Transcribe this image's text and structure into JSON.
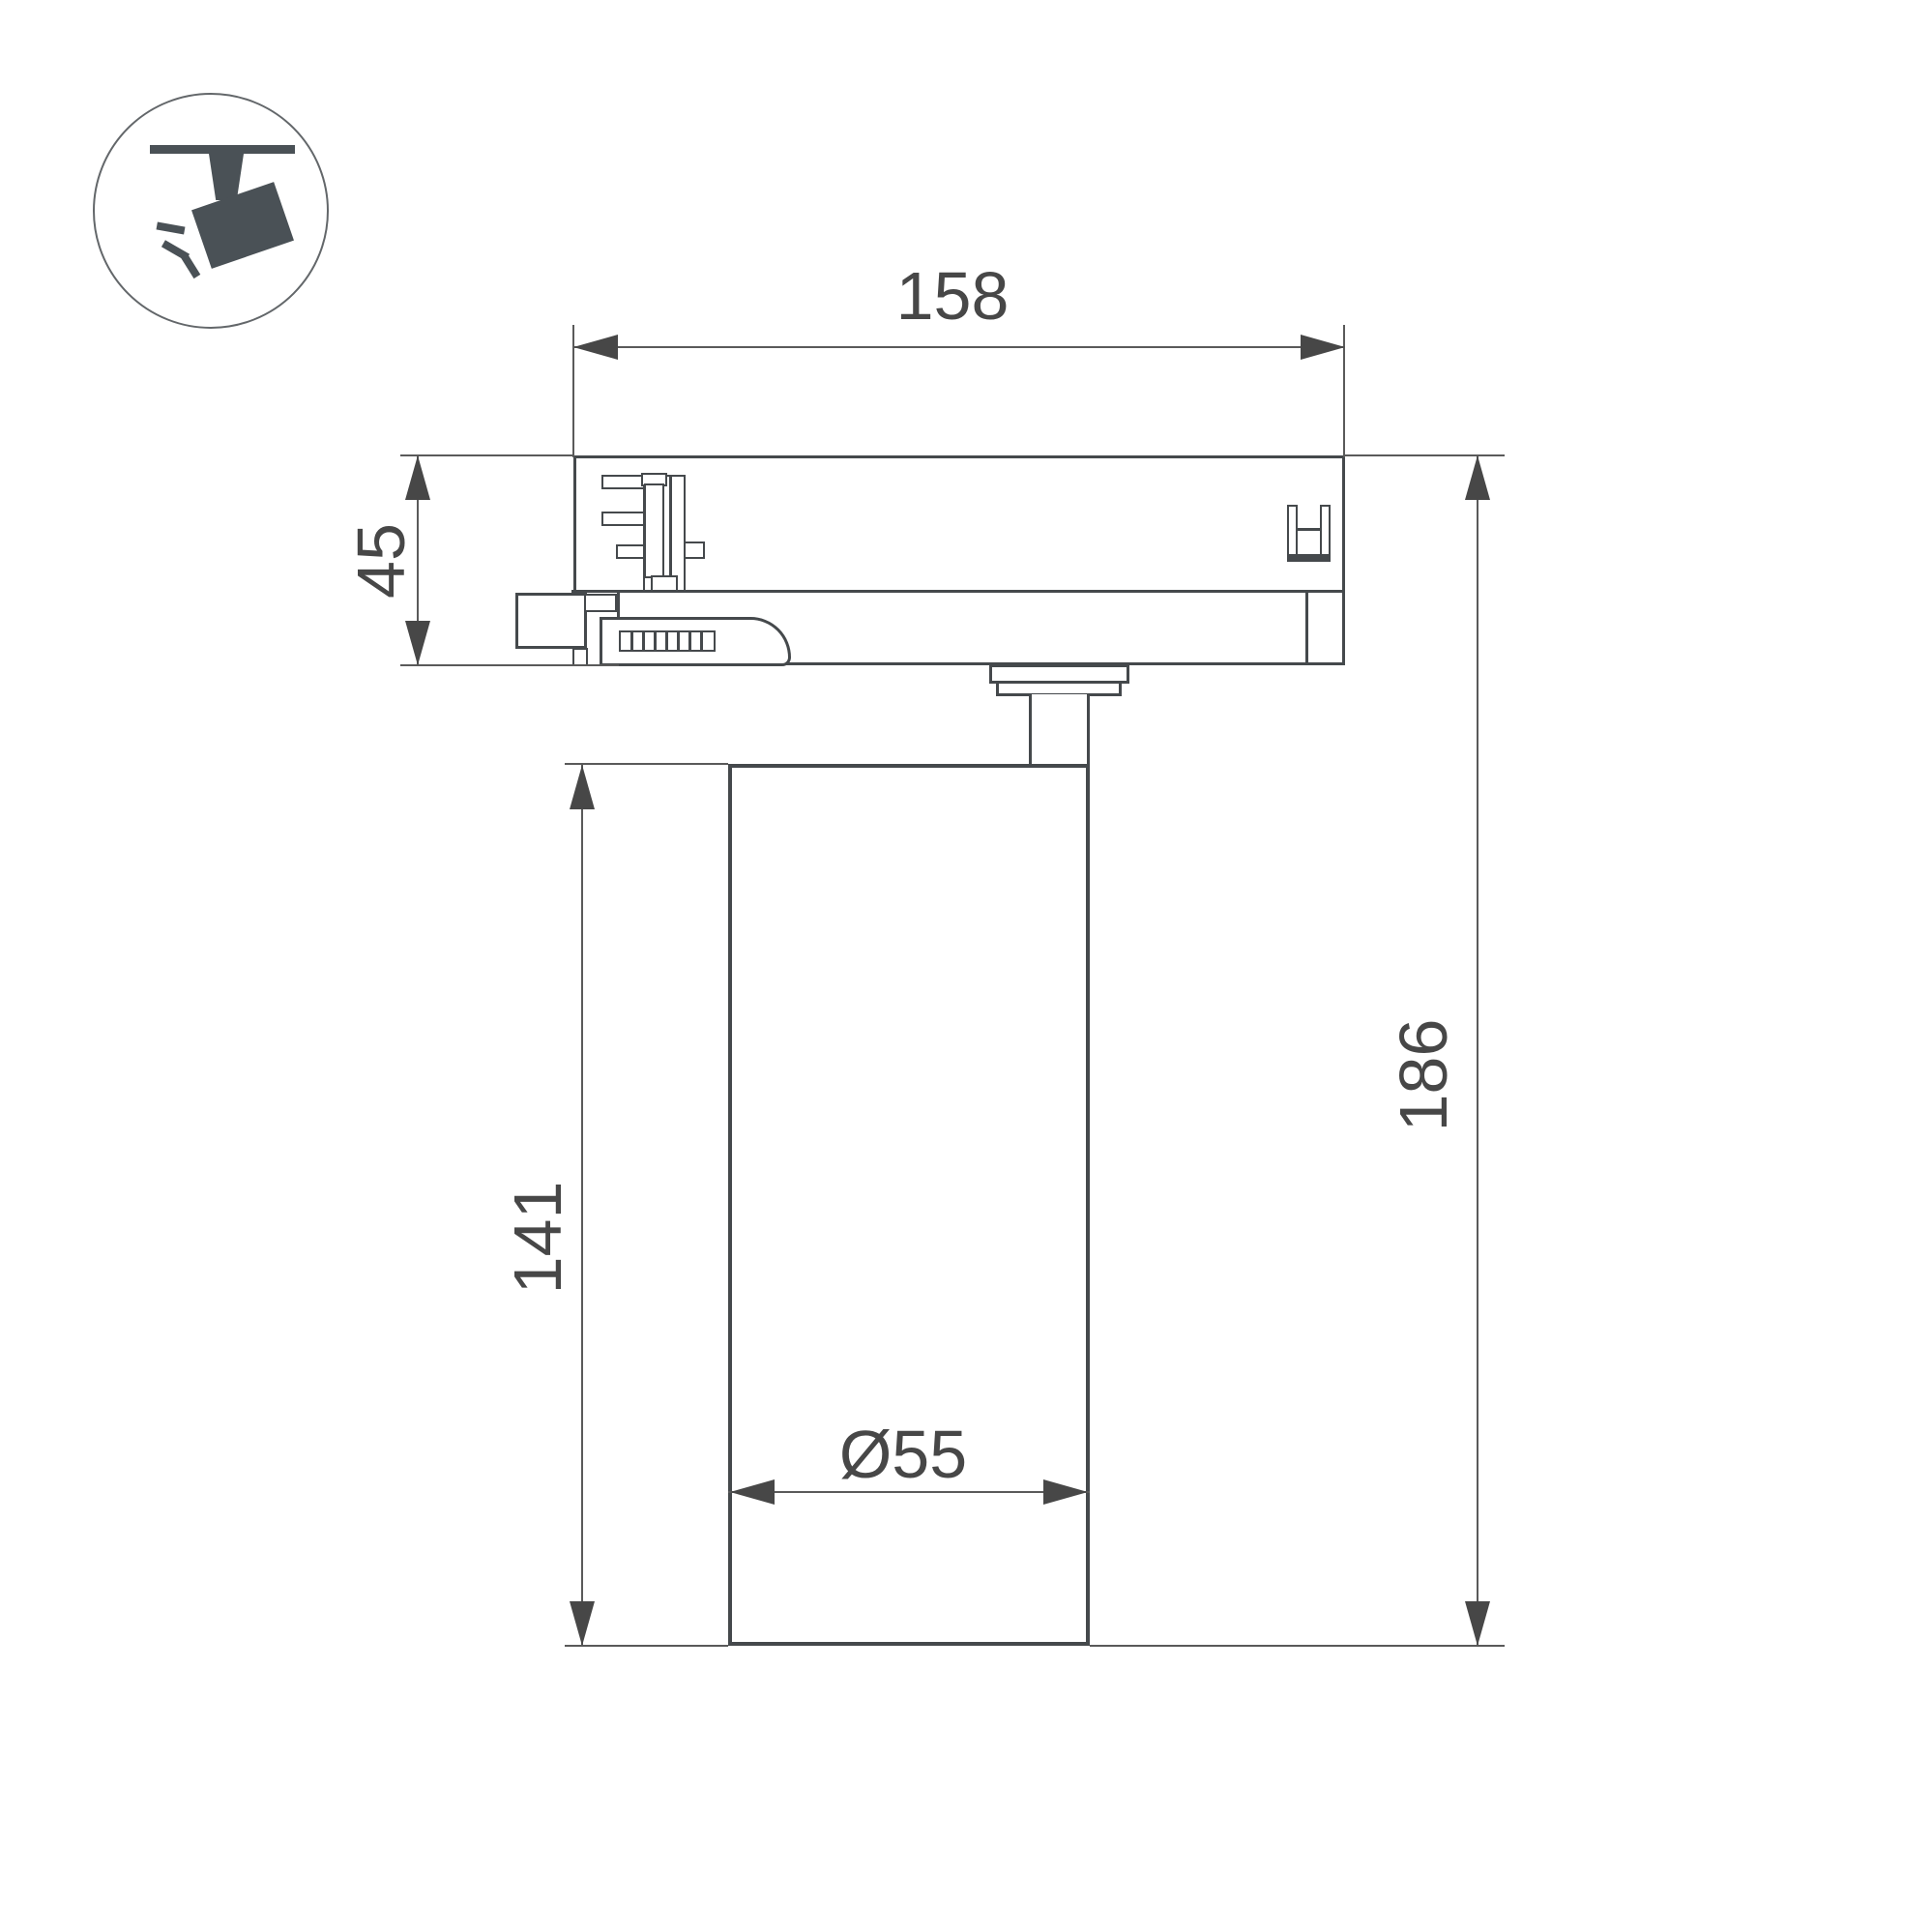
{
  "icon": {
    "name": "track-spotlight",
    "color": "#4a5156"
  },
  "drawing": {
    "type": "technical-dimension-drawing",
    "subject": "track light fixture side view"
  },
  "dimensions": {
    "track_adapter_width": "158",
    "track_adapter_height": "45",
    "lamp_body_height": "141",
    "total_height": "186",
    "lamp_diameter": "Ø55"
  },
  "colors": {
    "ink": "#45494c",
    "dim": "#5a5a5a",
    "txt": "#474747",
    "icon": "#4a5156",
    "bg": "#ffffff"
  }
}
